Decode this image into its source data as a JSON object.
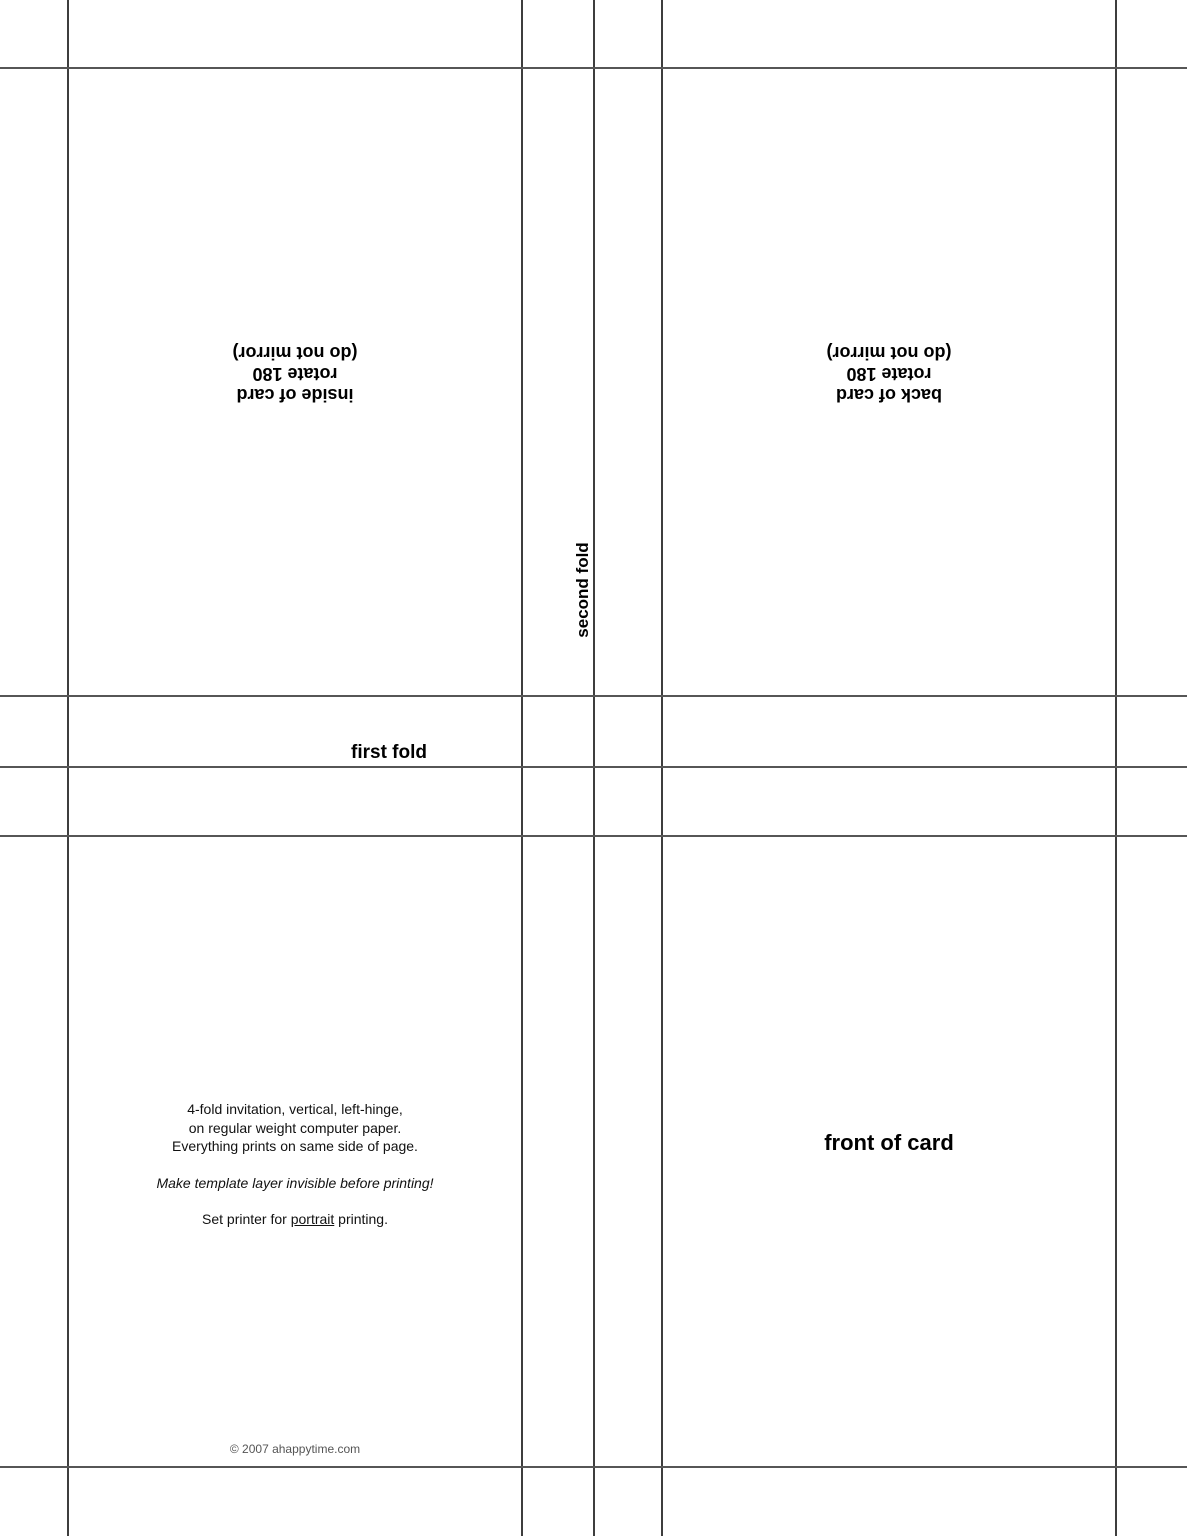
{
  "page": {
    "background_color": "#ffffff",
    "guide_line_color": "#4a4a4a",
    "text_color": "#000000",
    "copyright_color": "#555555"
  },
  "panels": {
    "inside": {
      "lines": [
        "inside of card",
        "rotate 180",
        "(do not mirror)"
      ]
    },
    "back": {
      "lines": [
        "back of card",
        "rotate 180",
        "(do not mirror)"
      ]
    },
    "front": {
      "label": "front of card"
    }
  },
  "fold_labels": {
    "first": "first fold",
    "second": "second fold"
  },
  "instructions": {
    "paragraph1": [
      "4-fold invitation, vertical, left-hinge,",
      "on regular weight computer paper.",
      "Everything prints on same side of page."
    ],
    "paragraph2": "Make template layer invisible before printing!",
    "paragraph3": {
      "prefix": "Set printer for ",
      "underlined": "portrait",
      "suffix": " printing."
    }
  },
  "footer": {
    "copyright": "© 2007 ahappytime.com"
  }
}
